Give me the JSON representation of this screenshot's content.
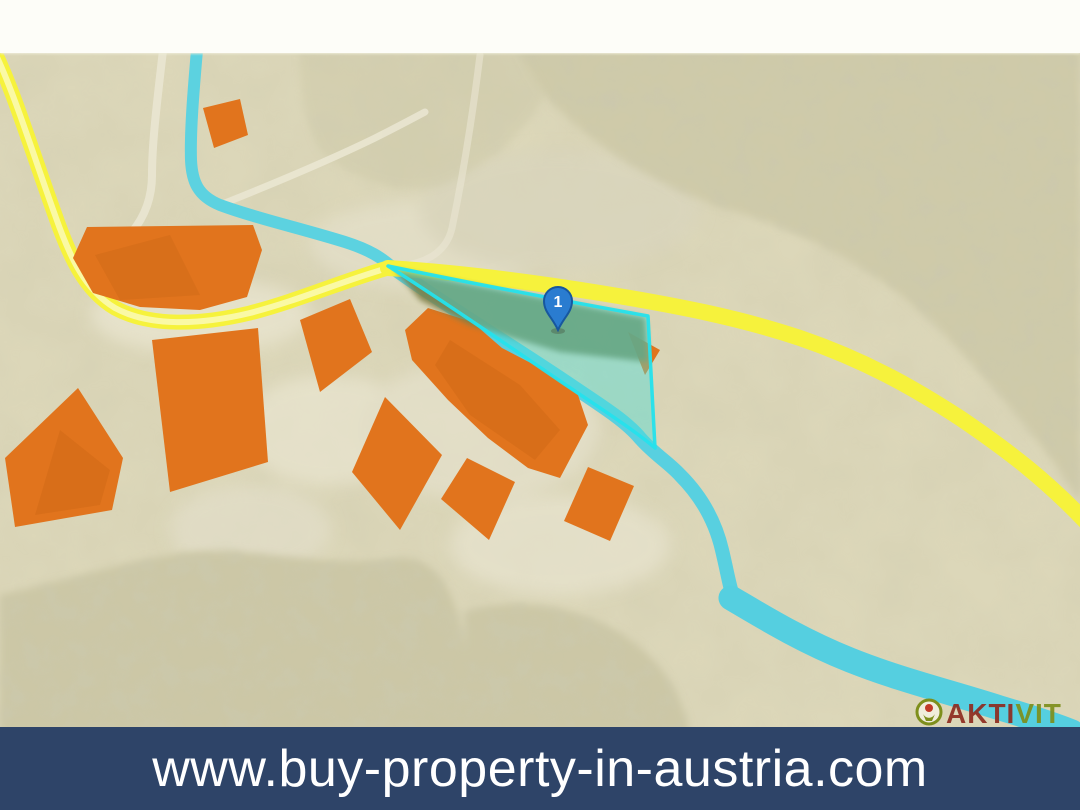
{
  "banner": {
    "url": "www.buy-property-in-austria.com",
    "background_color": "#2e4468",
    "text_color": "#ffffff"
  },
  "map": {
    "marker": {
      "label": "1",
      "fill_color": "#2a7cd0",
      "border_color": "#17579e"
    },
    "logo": {
      "part1": "AKTI",
      "part2": "VIT",
      "part1_color": "#8e2c20",
      "part2_color": "#7e8f1c"
    },
    "palette": {
      "terrain": "#dcd7b9",
      "forest": "#cfcaa9",
      "road": "#f6f23c",
      "road_core": "#fbf9b0",
      "river": "#5cd2e0",
      "building": "#e1741d",
      "parcel_fill": "#48ded8",
      "parcel_outline": "#25e2ec",
      "parcel_field": "#7e7f47",
      "top_strip": "#fdfdf8"
    }
  }
}
